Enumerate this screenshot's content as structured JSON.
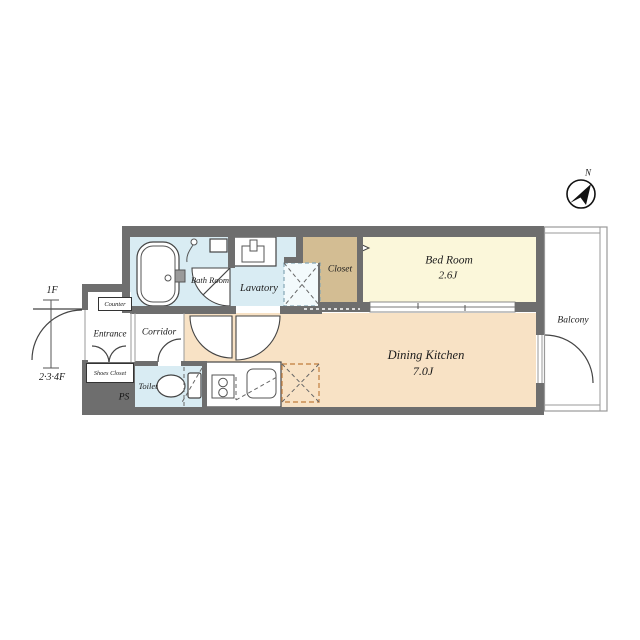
{
  "title": "Apartment floor plan 1K",
  "compass": {
    "label": "N"
  },
  "floor_indicator": {
    "top": "1F",
    "bottom": "2·3·4F"
  },
  "rooms": {
    "bath": {
      "label": "Bath Room"
    },
    "lavatory": {
      "label": "Lavatory"
    },
    "closet": {
      "label": "Closet"
    },
    "bedroom": {
      "label": "Bed Room",
      "size": "2.6J"
    },
    "dining_kitchen": {
      "label": "Dining Kitchen",
      "size": "7.0J"
    },
    "balcony": {
      "label": "Balcony"
    },
    "corridor": {
      "label": "Corridor"
    },
    "entrance": {
      "label": "Entrance"
    },
    "toilet": {
      "label": "Toilet"
    },
    "counter": {
      "label": "Counter"
    },
    "shoes_closet": {
      "label": "Shoes Closet"
    },
    "pipe_space": {
      "label": "PS"
    }
  },
  "fixtures": [
    "bathtub",
    "shower-head",
    "washbasin",
    "washing-machine-pan",
    "toilet-bowl",
    "stove",
    "kitchen-sink",
    "refrigerator-space",
    "sliding-door",
    "entrance-door",
    "bath-door",
    "lavatory-door",
    "corridor-door",
    "toilet-door",
    "balcony-door",
    "shoes-closet-doors",
    "closet-door-marker",
    "compass"
  ],
  "colors": {
    "wall": "#6e6e6e",
    "water": "#d9ecf3",
    "bedroom": "#fbf7da",
    "dk": "#f8e2c5",
    "closet": "#d3bd93",
    "line": "#444444",
    "thin": "#999999",
    "fridge_dash": "#c98c52",
    "pan_dash": "#85a7b5",
    "text": "#1b1b1b"
  }
}
